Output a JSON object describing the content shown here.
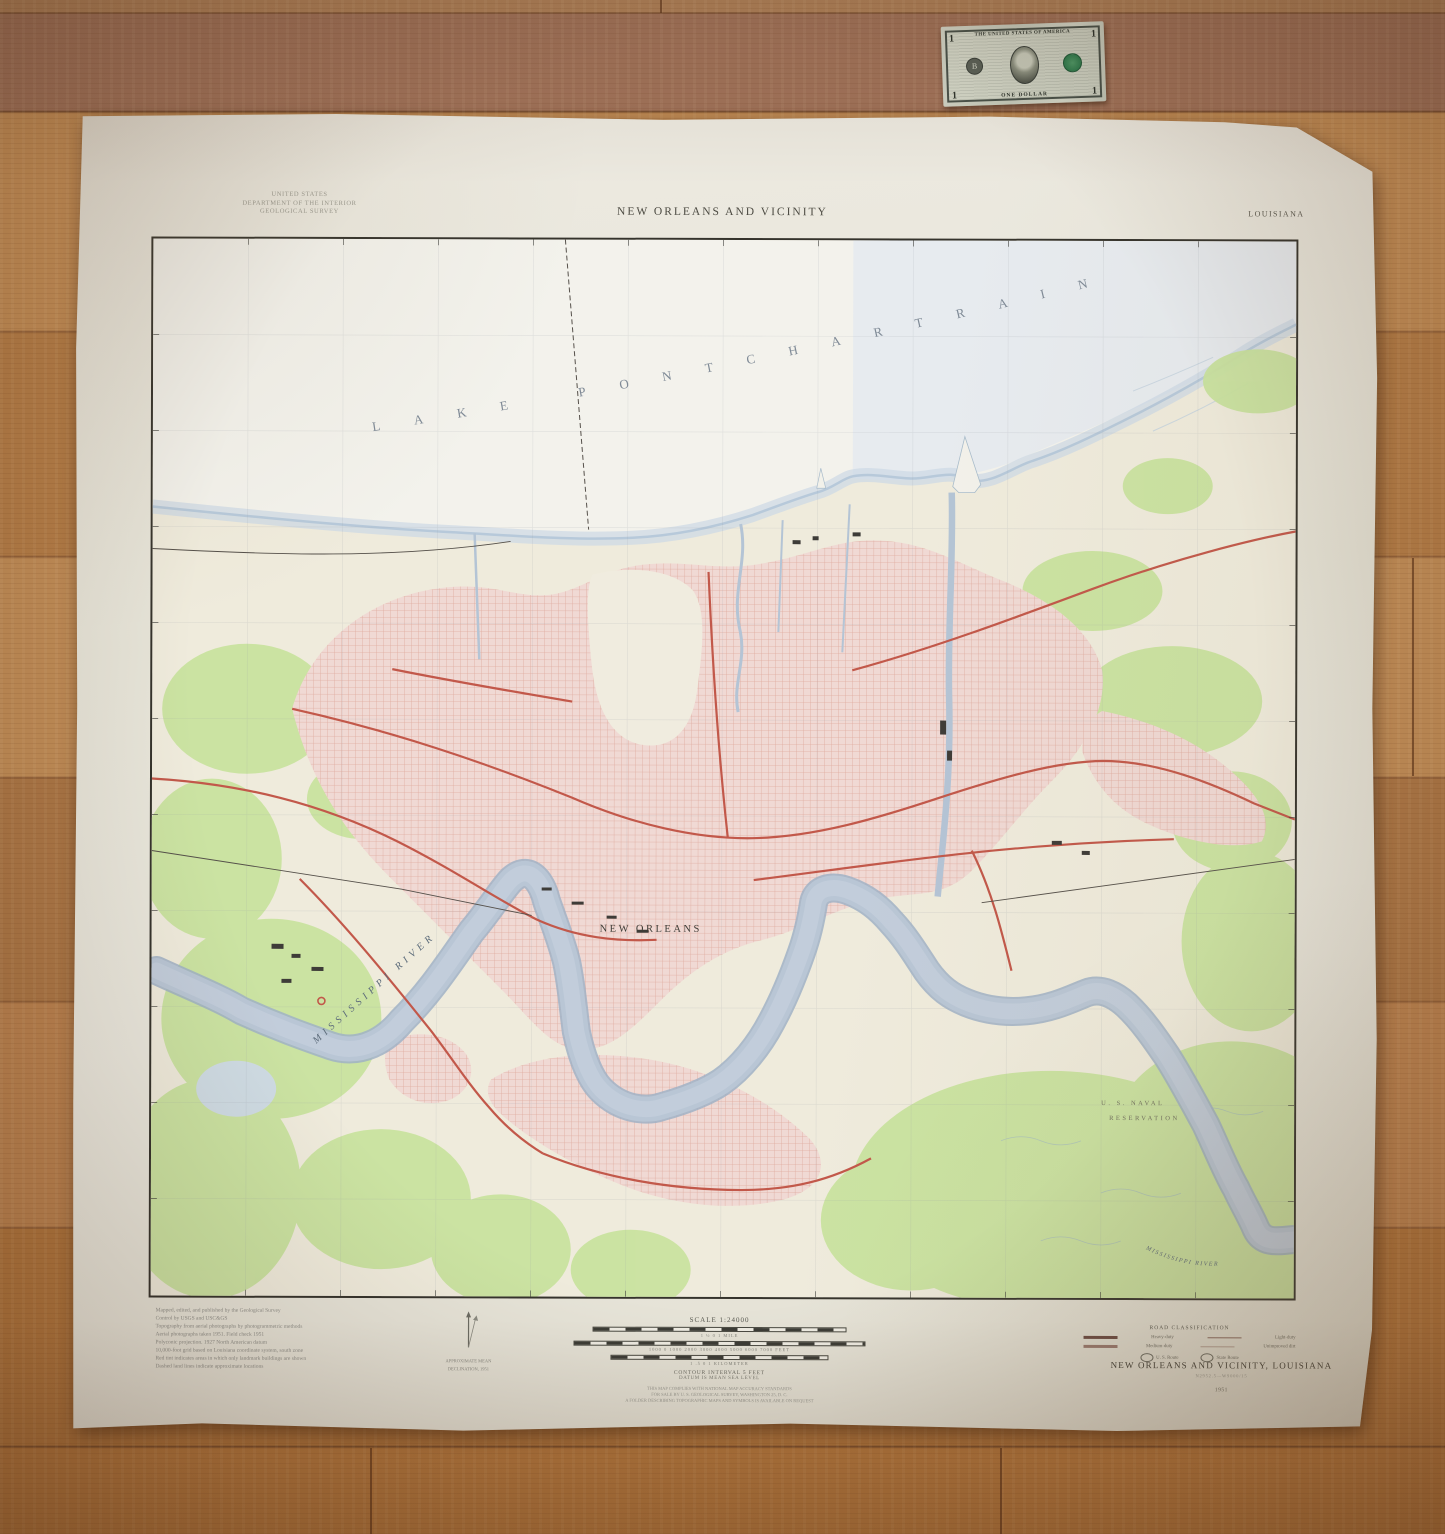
{
  "bill": {
    "top_text": "THE UNITED STATES OF AMERICA",
    "bottom_text": "ONE DOLLAR",
    "denomination": "1",
    "seal_letter": "B"
  },
  "map_margin": {
    "agency_line1": "UNITED STATES",
    "agency_line2": "DEPARTMENT OF THE INTERIOR",
    "agency_line3": "GEOLOGICAL SURVEY",
    "title": "NEW ORLEANS AND VICINITY",
    "state": "LOUISIANA",
    "credits": [
      "Mapped, edited, and published by the Geological Survey",
      "Control by USGS and USC&GS",
      "Topography from aerial photographs by photogrammetric methods",
      "Aerial photographs taken 1951.  Field check 1951",
      "Polyconic projection.  1927 North American datum",
      "10,000-foot grid based on Louisiana coordinate system, south zone",
      "Red tint indicates areas in which only landmark buildings are shown",
      "Dashed land lines indicate approximate locations"
    ],
    "declination_line1": "APPROXIMATE MEAN",
    "declination_line2": "DECLINATION, 1951",
    "scale": {
      "heading": "SCALE 1:24000",
      "miles_row": "1          ½          0                    1 MILE",
      "feet_row": "1000    0    1000   2000   3000   4000   5000   6000   7000 FEET",
      "km_row": "1      .5      0                 1 KILOMETER",
      "contour": "CONTOUR INTERVAL 5 FEET",
      "datum": "DATUM IS MEAN SEA LEVEL",
      "notes": [
        "THIS MAP COMPLIES WITH NATIONAL MAP ACCURACY STANDARDS",
        "FOR SALE BY U. S. GEOLOGICAL SURVEY, WASHINGTON 25, D. C.",
        "A FOLDER DESCRIBING TOPOGRAPHIC MAPS AND SYMBOLS IS AVAILABLE ON REQUEST"
      ]
    },
    "road_class": {
      "heading": "ROAD CLASSIFICATION",
      "row1_left": "Heavy-duty",
      "row1_right": "Light-duty",
      "row2_left": "Medium-duty",
      "row2_right": "Unimproved dirt",
      "route_us": "U. S. Route",
      "route_state": "State Route"
    },
    "footer_title": "NEW ORLEANS AND VICINITY, LOUISIANA",
    "footer_ref": "N2952.5—W9000/15",
    "footer_year": "1951"
  },
  "map_labels": {
    "lake": "LAKE PONTCHARTRAIN",
    "city": "NEW ORLEANS",
    "river_west": "MISSISSIPPI RIVER",
    "river_southeast": "MISSISSIPPI RIVER",
    "naval_line1": "U. S. NAVAL",
    "naval_line2": "RESERVATION"
  },
  "colors": {
    "urban_pink": "#f0d9d4",
    "vegetation_green": "#c9e39f",
    "water_blue": "#b9c6d5",
    "road_red": "#c2584a",
    "paper": "#e9e7dd"
  }
}
